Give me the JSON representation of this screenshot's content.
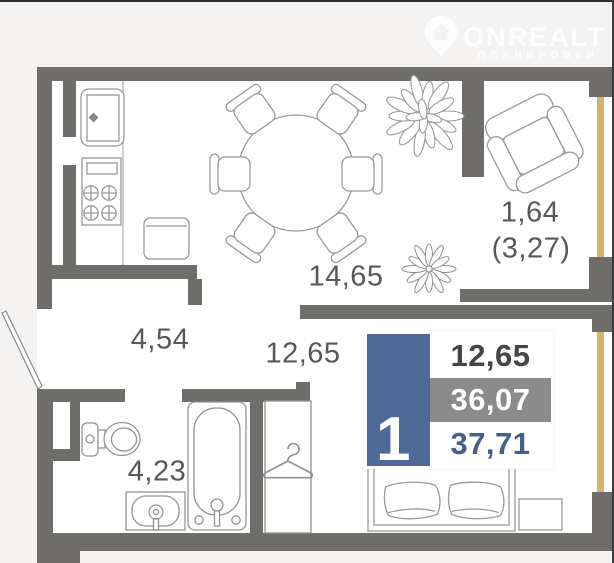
{
  "watermark": {
    "brand": "ONREALT",
    "tagline": "ПЛАНИРОВКИ",
    "icon": "location-pin-house-icon"
  },
  "labels": {
    "kitchen_living": "14,65",
    "hallway": "4,54",
    "bedroom": "12,65",
    "bathroom": "4,23",
    "balcony_area_reduced": "1,64",
    "balcony_area_full": "(3,27)"
  },
  "summary": {
    "rooms": "1",
    "living_area": "12,65",
    "area_without_balcony": "36,07",
    "total_area": "37,71"
  },
  "colors": {
    "accent_blue": "#4d6a98",
    "summary_gray": "#8b8b8b",
    "wall_gray": "#6f6e6b",
    "window_gold": "#d7b269",
    "label_text": "#58585a"
  },
  "furniture_icons": [
    "kitchen-sink-icon",
    "stove-icon",
    "cabinet-icon",
    "dining-table-icon",
    "chair-icon",
    "plant-icon",
    "armchair-icon",
    "toilet-icon",
    "washbasin-icon",
    "bathtub-icon",
    "wardrobe-icon",
    "hanger-icon",
    "double-bed-icon",
    "pillow-icon",
    "nightstand-icon",
    "entry-door-icon"
  ]
}
